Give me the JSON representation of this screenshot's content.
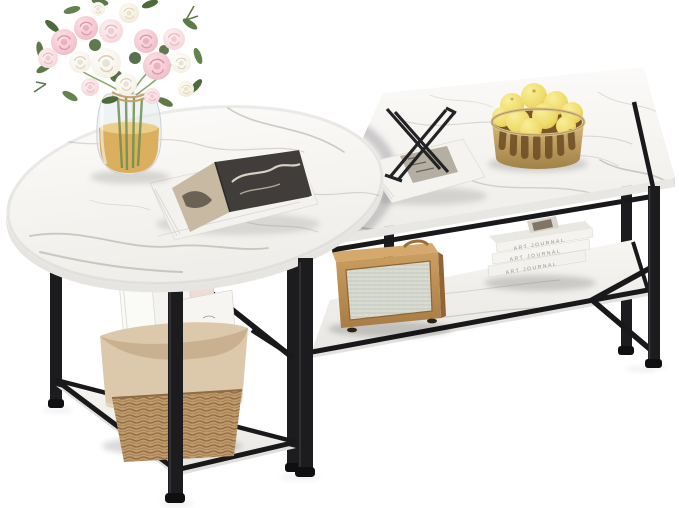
{
  "meta": {
    "domain": "product-photo",
    "subject": "Two-piece nesting coffee table set with white faux marble tops and black metal frames",
    "background_color": "#ffffff"
  },
  "scene": {
    "tables": {
      "round_table": {
        "name": "round nesting coffee table",
        "top": "white faux marble",
        "frame": "black metal",
        "shelf": "triangular marble lower shelf"
      },
      "rect_table": {
        "name": "rectangular coffee table",
        "top": "white faux marble",
        "frame": "black metal",
        "shelf": "marble lower storage shelf",
        "braces": "V-shaped side braces"
      }
    },
    "decor": {
      "bouquet": {
        "name": "rose bouquet",
        "colors": [
          "pink",
          "blush",
          "white",
          "cream"
        ],
        "greenery": true
      },
      "vase": {
        "name": "clear glass vase",
        "liquid": "amber water",
        "tie": "raffia ribbon"
      },
      "open_book": {
        "name": "open art magazine",
        "spread": "black and white photo"
      },
      "styled_book": {
        "name": "white art book",
        "object": "black wire sculpture"
      },
      "lemon_basket": {
        "name": "gold metal basket",
        "contents": "lemons"
      },
      "radio": {
        "name": "rattan vintage radio speaker"
      },
      "journal_stack": {
        "name": "stack of white art journals",
        "count": 3,
        "spine_text": "ART JOURNAL"
      },
      "magazine_basket": {
        "name": "woven wicker basket",
        "liner": "beige fabric",
        "contents": "magazines"
      }
    }
  },
  "palette": {
    "background": "#ffffff",
    "marble": "#f8f7f4",
    "marble_vein": "#b0aca5",
    "metal_black": "#1c1c1e",
    "gold": "#c2a368",
    "lemon_yellow": "#f1dd6d",
    "rose_pink": "#f0bcc8",
    "blush": "#f6d7dc",
    "cream": "#f4efe4",
    "leaf_green": "#5c7a48",
    "amber": "#d8a74e",
    "rattan": "#c09a6b",
    "fabric_beige": "#dcc9ac",
    "wood_tan": "#c4945a",
    "mesh": "#e3e6de",
    "photo_dark": "#3e3b37"
  }
}
